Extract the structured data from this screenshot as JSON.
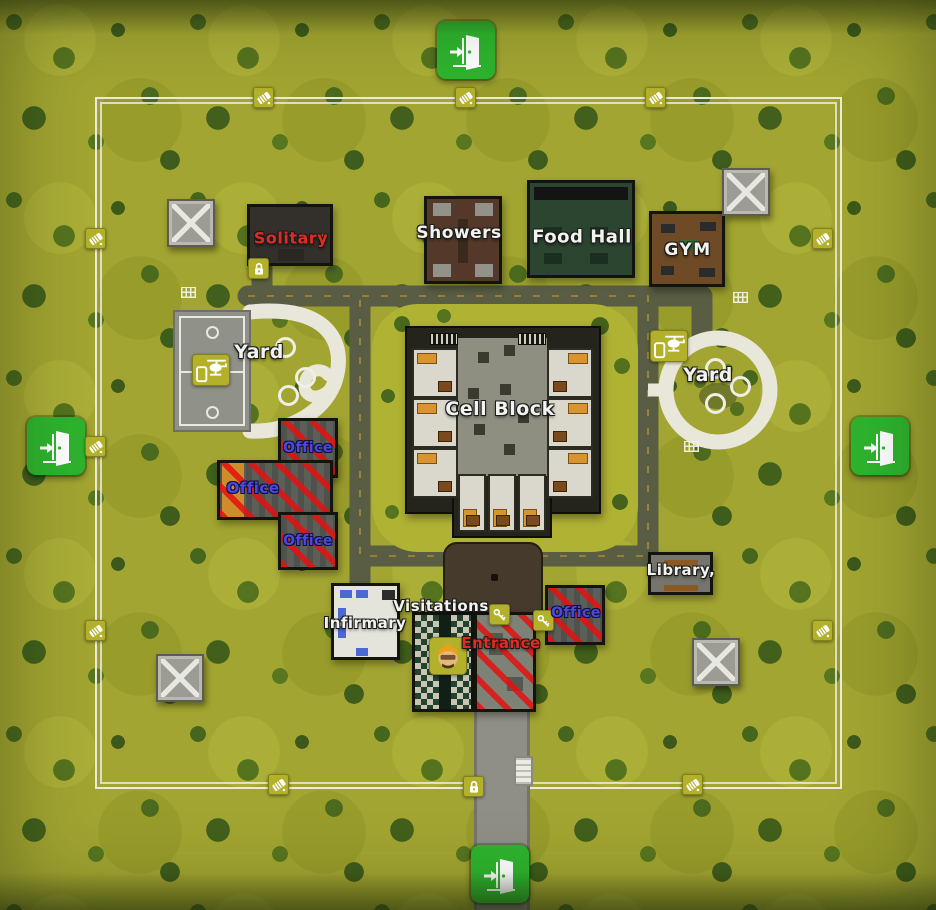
{
  "rooms": {
    "solitary": {
      "label": "Solitary",
      "label_color": "#e02b22"
    },
    "showers": {
      "label": "Showers",
      "label_color": "#f2f2ee"
    },
    "food_hall": {
      "label": "Food Hall",
      "label_color": "#f2f2ee"
    },
    "gym": {
      "label": "GYM",
      "label_color": "#f2f2ee"
    },
    "yard_left": {
      "label": "Yard",
      "label_color": "#f2f2ee"
    },
    "yard_right": {
      "label": "Yard",
      "label_color": "#f2f2ee"
    },
    "cell_block": {
      "label": "Cell Block",
      "label_color": "#f2f2ee"
    },
    "office_top": {
      "label": "Office",
      "label_color": "#4a49dc"
    },
    "office_left": {
      "label": "Office",
      "label_color": "#4a49dc"
    },
    "office_bottom": {
      "label": "Office",
      "label_color": "#4a49dc"
    },
    "office_gate": {
      "label": "Office",
      "label_color": "#4a49dc"
    },
    "library": {
      "label": "Library,",
      "label_color": "#f2f2ee"
    },
    "infirmary": {
      "label": "Infirmary",
      "label_color": "#f2f2ee"
    },
    "visitations": {
      "label": "Visitations",
      "label_color": "#f2f2ee"
    },
    "entrance": {
      "label": "Entrance",
      "label_color": "#e02b22"
    }
  },
  "icons": {
    "exit_door": "green square with white open door and arrow (4: top, left, right, bottom)",
    "fence_marker": "olive square with white diagonal roll",
    "padlock": "olive square with white padlock",
    "key": "olive square with white key",
    "helicopter_phone": "olive square with white helicopter and phone",
    "player_head": "olive square with orange-haired character face",
    "guard_tower": "grey square with white X roof",
    "goal_net": "small white grid"
  },
  "colors": {
    "grass": "#a2a531",
    "tree_dark": "#42601c",
    "exit_green": "#2eb42e",
    "marker_olive": "#b3b12b",
    "restricted_stripe_red": "#e41010",
    "road_olive": "#585d43",
    "path_white": "#e9e7da",
    "fence_white": "#eceadf",
    "label_white": "#f2f2ee",
    "label_red": "#e02b22",
    "label_blue": "#4a49dc"
  }
}
